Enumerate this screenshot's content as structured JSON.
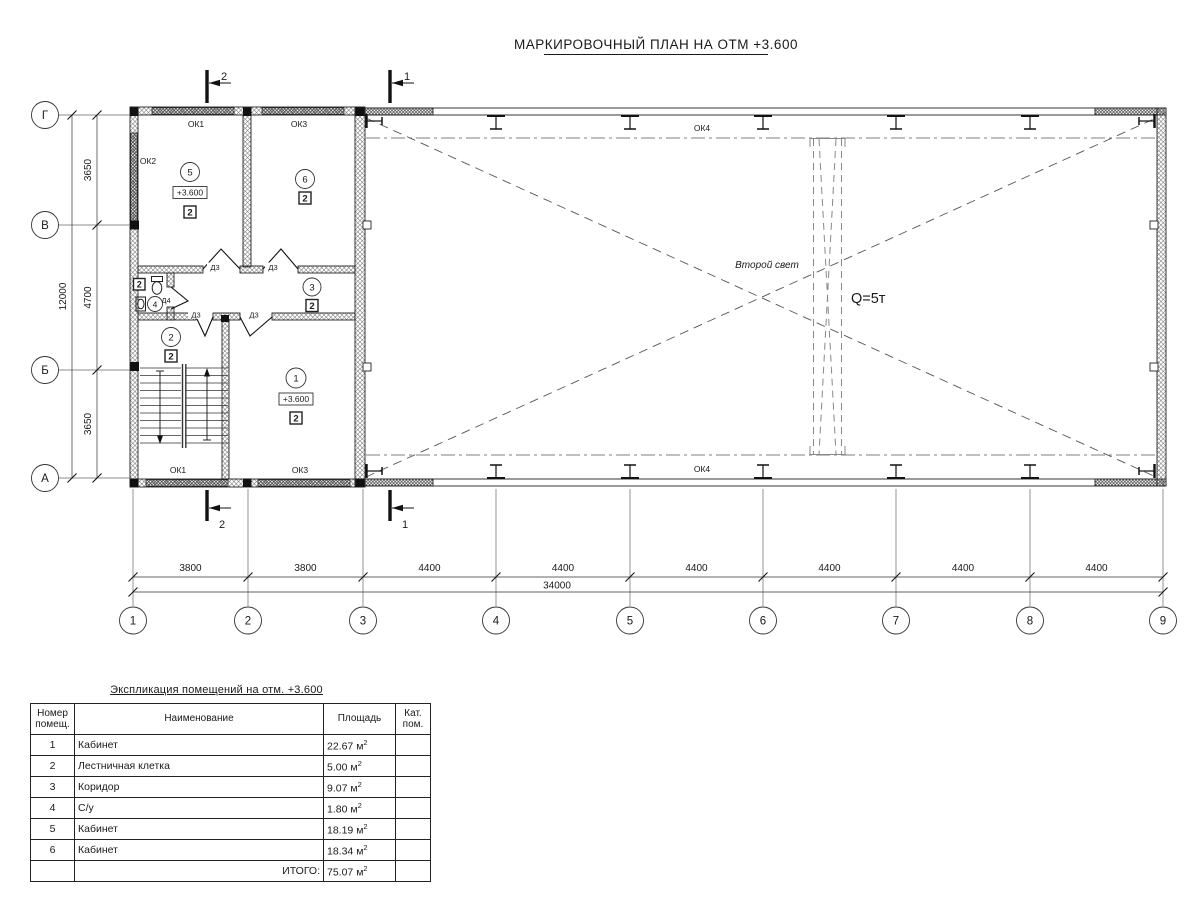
{
  "title": "МАРКИРОВОЧНЫЙ ПЛАН НА ОТМ +3.600",
  "plan": {
    "axes": {
      "horizontal": [
        "1",
        "2",
        "3",
        "4",
        "5",
        "6",
        "7",
        "8",
        "9"
      ],
      "vertical": [
        "Г",
        "В",
        "Б",
        "А"
      ]
    },
    "dims": {
      "bottom": [
        "3800",
        "3800",
        "4400",
        "4400",
        "4400",
        "4400",
        "4400",
        "4400"
      ],
      "bottom_total": "34000",
      "left": [
        "3650",
        "4700",
        "3650"
      ],
      "left_total": "12000"
    },
    "sections": {
      "s1": "1",
      "s2": "2"
    },
    "windows": {
      "ok1": "ОК1",
      "ok2": "ОК2",
      "ok3": "ОК3",
      "ok4": "ОК4"
    },
    "doors": {
      "d3": "Д3",
      "d4": "Д4"
    },
    "rooms": {
      "r1": {
        "num": "1",
        "elev": "+3.600",
        "cat": "2"
      },
      "r2": {
        "num": "2",
        "cat": "2"
      },
      "r3": {
        "num": "3",
        "cat": "2"
      },
      "r4": {
        "num": "4",
        "cat": "2"
      },
      "r5": {
        "num": "5",
        "elev": "+3.600",
        "cat": "2"
      },
      "r6": {
        "num": "6",
        "cat": "2"
      }
    },
    "hall": {
      "second_light": "Второй свет",
      "crane_capacity": "Q=5т"
    }
  },
  "table": {
    "title": "Экспликация помещений на отм. +3.600",
    "headers": {
      "num": "Номер\nпомещ.",
      "name": "Наименование",
      "area": "Площадь",
      "cat": "Кат.\nпом."
    },
    "rows": [
      {
        "num": "1",
        "name": "Кабинет",
        "area": "22.67 м",
        "sup": "2",
        "cat": ""
      },
      {
        "num": "2",
        "name": "Лестничная клетка",
        "area": "5.00 м",
        "sup": "2",
        "cat": ""
      },
      {
        "num": "3",
        "name": "Коридор",
        "area": "9.07 м",
        "sup": "2",
        "cat": ""
      },
      {
        "num": "4",
        "name": "С/у",
        "area": "1.80 м",
        "sup": "2",
        "cat": ""
      },
      {
        "num": "5",
        "name": "Кабинет",
        "area": "18.19 м",
        "sup": "2",
        "cat": ""
      },
      {
        "num": "6",
        "name": "Кабинет",
        "area": "18.34 м",
        "sup": "2",
        "cat": ""
      }
    ],
    "total_label": "ИТОГО:",
    "total_area": "75.07 м",
    "total_sup": "2"
  }
}
